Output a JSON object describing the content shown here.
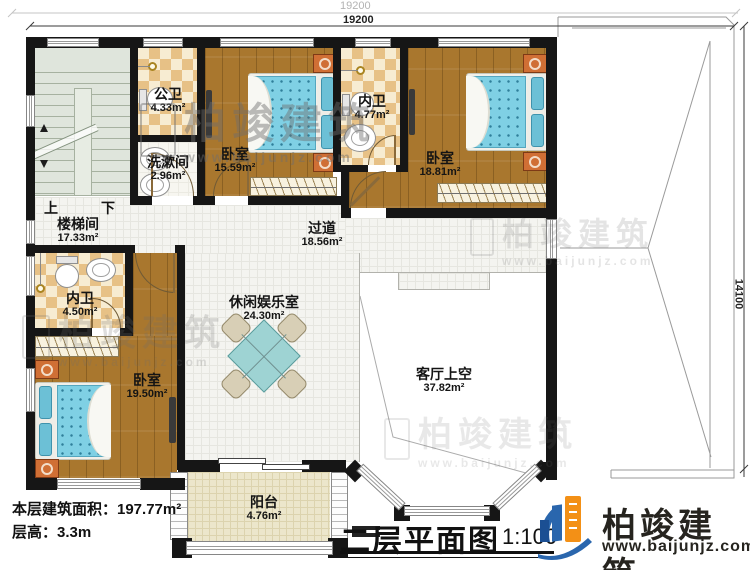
{
  "dimensions": {
    "top_outer": "19200",
    "top_inner": "19200",
    "right": "14100"
  },
  "stairs": {
    "up": "上",
    "down": "下"
  },
  "rooms": {
    "stairwell": {
      "name": "楼梯间",
      "area": "17.33m²"
    },
    "public_bath": {
      "name": "公卫",
      "area": "4.33m²"
    },
    "washroom": {
      "name": "洗漱间",
      "area": "2.96m²"
    },
    "bedroom1": {
      "name": "卧室",
      "area": "15.59m²"
    },
    "ensuite1": {
      "name": "内卫",
      "area": "4.77m²"
    },
    "bedroom2": {
      "name": "卧室",
      "area": "18.81m²"
    },
    "hallway": {
      "name": "过道",
      "area": "18.56m²"
    },
    "ensuite2": {
      "name": "内卫",
      "area": "4.50m²"
    },
    "bedroom3": {
      "name": "卧室",
      "area": "19.50m²"
    },
    "leisure": {
      "name": "休闲娱乐室",
      "area": "24.30m²"
    },
    "living_void": {
      "name": "客厅上空",
      "area": "37.82m²"
    },
    "balcony": {
      "name": "阳台",
      "area": "4.76m²"
    }
  },
  "footer": {
    "area_line": "本层建筑面积：197.77m²",
    "height_line": "层高：3.3m"
  },
  "titleblock": {
    "title": "二层平面图",
    "scale": "1:100"
  },
  "brand": {
    "name": "柏竣建筑",
    "url": "www.baijunjz.com",
    "color_blue": "#2a66ad",
    "color_orange": "#f39016"
  },
  "watermark": {
    "name": "柏竣建筑",
    "url": "www.baijunjz.com"
  },
  "palette": {
    "wall": "#161616",
    "wood_floor": "#a9772e",
    "tile_floor": "#f4f4f0",
    "checker_tan": "#e7c186",
    "stair_green": "#dfe5dc",
    "balcony_cream": "#ece6cb",
    "mattress_blue": "#7fd0e4",
    "nightstand_orange": "#d06f35"
  }
}
